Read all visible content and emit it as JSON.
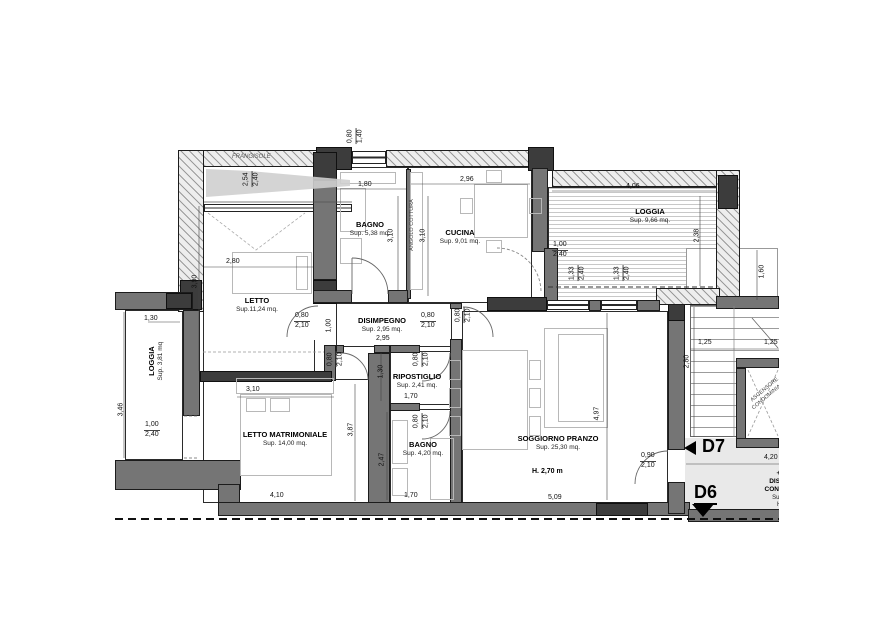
{
  "rooms": {
    "letto": {
      "name": "LETTO",
      "sup": "Sup.11,24 mq."
    },
    "bagno1": {
      "name": "BAGNO",
      "sup": "Sup. 5,38 mq."
    },
    "cucina": {
      "name": "CUCINA",
      "sup": "Sup. 9,01 mq."
    },
    "loggia_top": {
      "name": "LOGGIA",
      "sup": "Sup. 9,66 mq."
    },
    "loggia_left": {
      "name": "LOGGIA",
      "sup": "Sup. 3,81 mq"
    },
    "disimpegno": {
      "name": "DISIMPEGNO",
      "sup": "Sup. 2,95 mq."
    },
    "ripostiglio": {
      "name": "RIPOSTIGLIO",
      "sup": "Sup. 2,41 mq."
    },
    "bagno2": {
      "name": "BAGNO",
      "sup": "Sup. 4,20 mq."
    },
    "letto_matrimoniale": {
      "name": "LETTO MATRIMONIALE",
      "sup": "Sup. 14,00 mq."
    },
    "soggiorno": {
      "name": "SOGGIORNO PRANZO",
      "sup": "Sup. 25,30 mq.",
      "height": "H. 2,70 m"
    },
    "disimpegno_condominiale": {
      "level": "+3,20 m",
      "name_line1": "DISIMPEGNO",
      "name_line2": "CONDOMINIALE",
      "sup": "Sup. 8,50 mq",
      "height": "H. 2,70 m"
    },
    "ascensore": {
      "name_line1": "ASCENSORE",
      "name_line2": "CONDOMINIALE"
    }
  },
  "annotations": {
    "frangisole": "FRANGISOLE",
    "angolo_cottura": "ANGOLO COTTURA",
    "unit_d7": "D7",
    "unit_d6": "D6"
  },
  "dims": {
    "top_window": {
      "w": "0,80",
      "h": "1,40"
    },
    "frangisole": {
      "w": "2,54",
      "h": "2,40"
    },
    "letto_w": "2,80",
    "letto_h": "3,90",
    "bagno1_w": "1,80",
    "bagno1_h": "3,10",
    "cucina_w": "2,96",
    "cucina_h": "3,10",
    "loggia_top_w": "4,06",
    "loggia_top_h": "2,38",
    "porta_loggia": {
      "w": "1,00",
      "h": "2,40"
    },
    "finestra1": {
      "w": "1,33",
      "h": "2,40"
    },
    "finestra2": {
      "w": "1,33",
      "h": "2,40"
    },
    "right_side": "1,60",
    "loggia_left_w": "1,30",
    "loggia_left_h": "3,46",
    "porta_loggia_left": {
      "w": "1,00",
      "h": "2,40"
    },
    "porta_letto": {
      "w": "0,80",
      "h": "2,10"
    },
    "letto_door_side": "1,00",
    "disimpegno_w": "2,95",
    "porta_soggiorno": {
      "w": "0,80",
      "h": "2,10"
    },
    "porta_cucina": {
      "w": "0,80",
      "h": "2,10"
    },
    "porta_matrimoniale": {
      "w": "0,80",
      "h": "2,10"
    },
    "porta_ripostiglio": {
      "w": "0,80",
      "h": "2,10"
    },
    "ripostiglio_h": "1,30",
    "ripostiglio_w": "1,70",
    "porta_bagno2": {
      "w": "0,80",
      "h": "2,10"
    },
    "bagno2_h": "2,47",
    "bagno2_w": "1,70",
    "matrimoniale_w_int": "3,10",
    "matrimoniale_h": "3,87",
    "matrimoniale_w": "4,10",
    "soggiorno_w": "5,09",
    "soggiorno_h": "4,97",
    "porta_ingresso": {
      "w": "0,90",
      "h": "2,10"
    },
    "stair_1": "1,25",
    "stair_2": "1,25",
    "stair_h": "2,80",
    "hall_w": "4,20"
  }
}
